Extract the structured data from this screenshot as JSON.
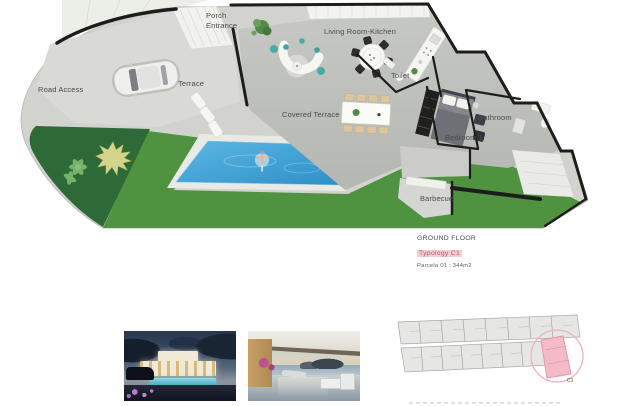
{
  "floor_plan": {
    "labels": {
      "road_access": "Road Access",
      "terrace": "Terrace",
      "porch_entrance": "Porch Entrance",
      "living_room_kitchen": "Living Room-Kitchen",
      "covered_terrace": "Covered Terrace",
      "toilet": "Toilet",
      "bathroom": "Bathroom",
      "bedroom_1": "Bedroom 1",
      "barbecue": "Barbecue"
    }
  },
  "title_block": {
    "floor": "GROUND FLOOR",
    "typology": "Typology C1",
    "parcel": "Parcela 01 : 344m2"
  },
  "site_plan": {
    "highlighted_unit": "C1"
  },
  "gallery": {
    "items": [
      {
        "name": "exterior-night-render"
      },
      {
        "name": "covered-terrace-sea-view-render"
      }
    ]
  },
  "colors": {
    "lawn": "#4f9340",
    "garden": "#2e6a37",
    "pool": "#3fa0d4",
    "wall": "#1d1d1b",
    "accent_text": "#c94f63",
    "accent_bg": "#f5cdd4"
  }
}
